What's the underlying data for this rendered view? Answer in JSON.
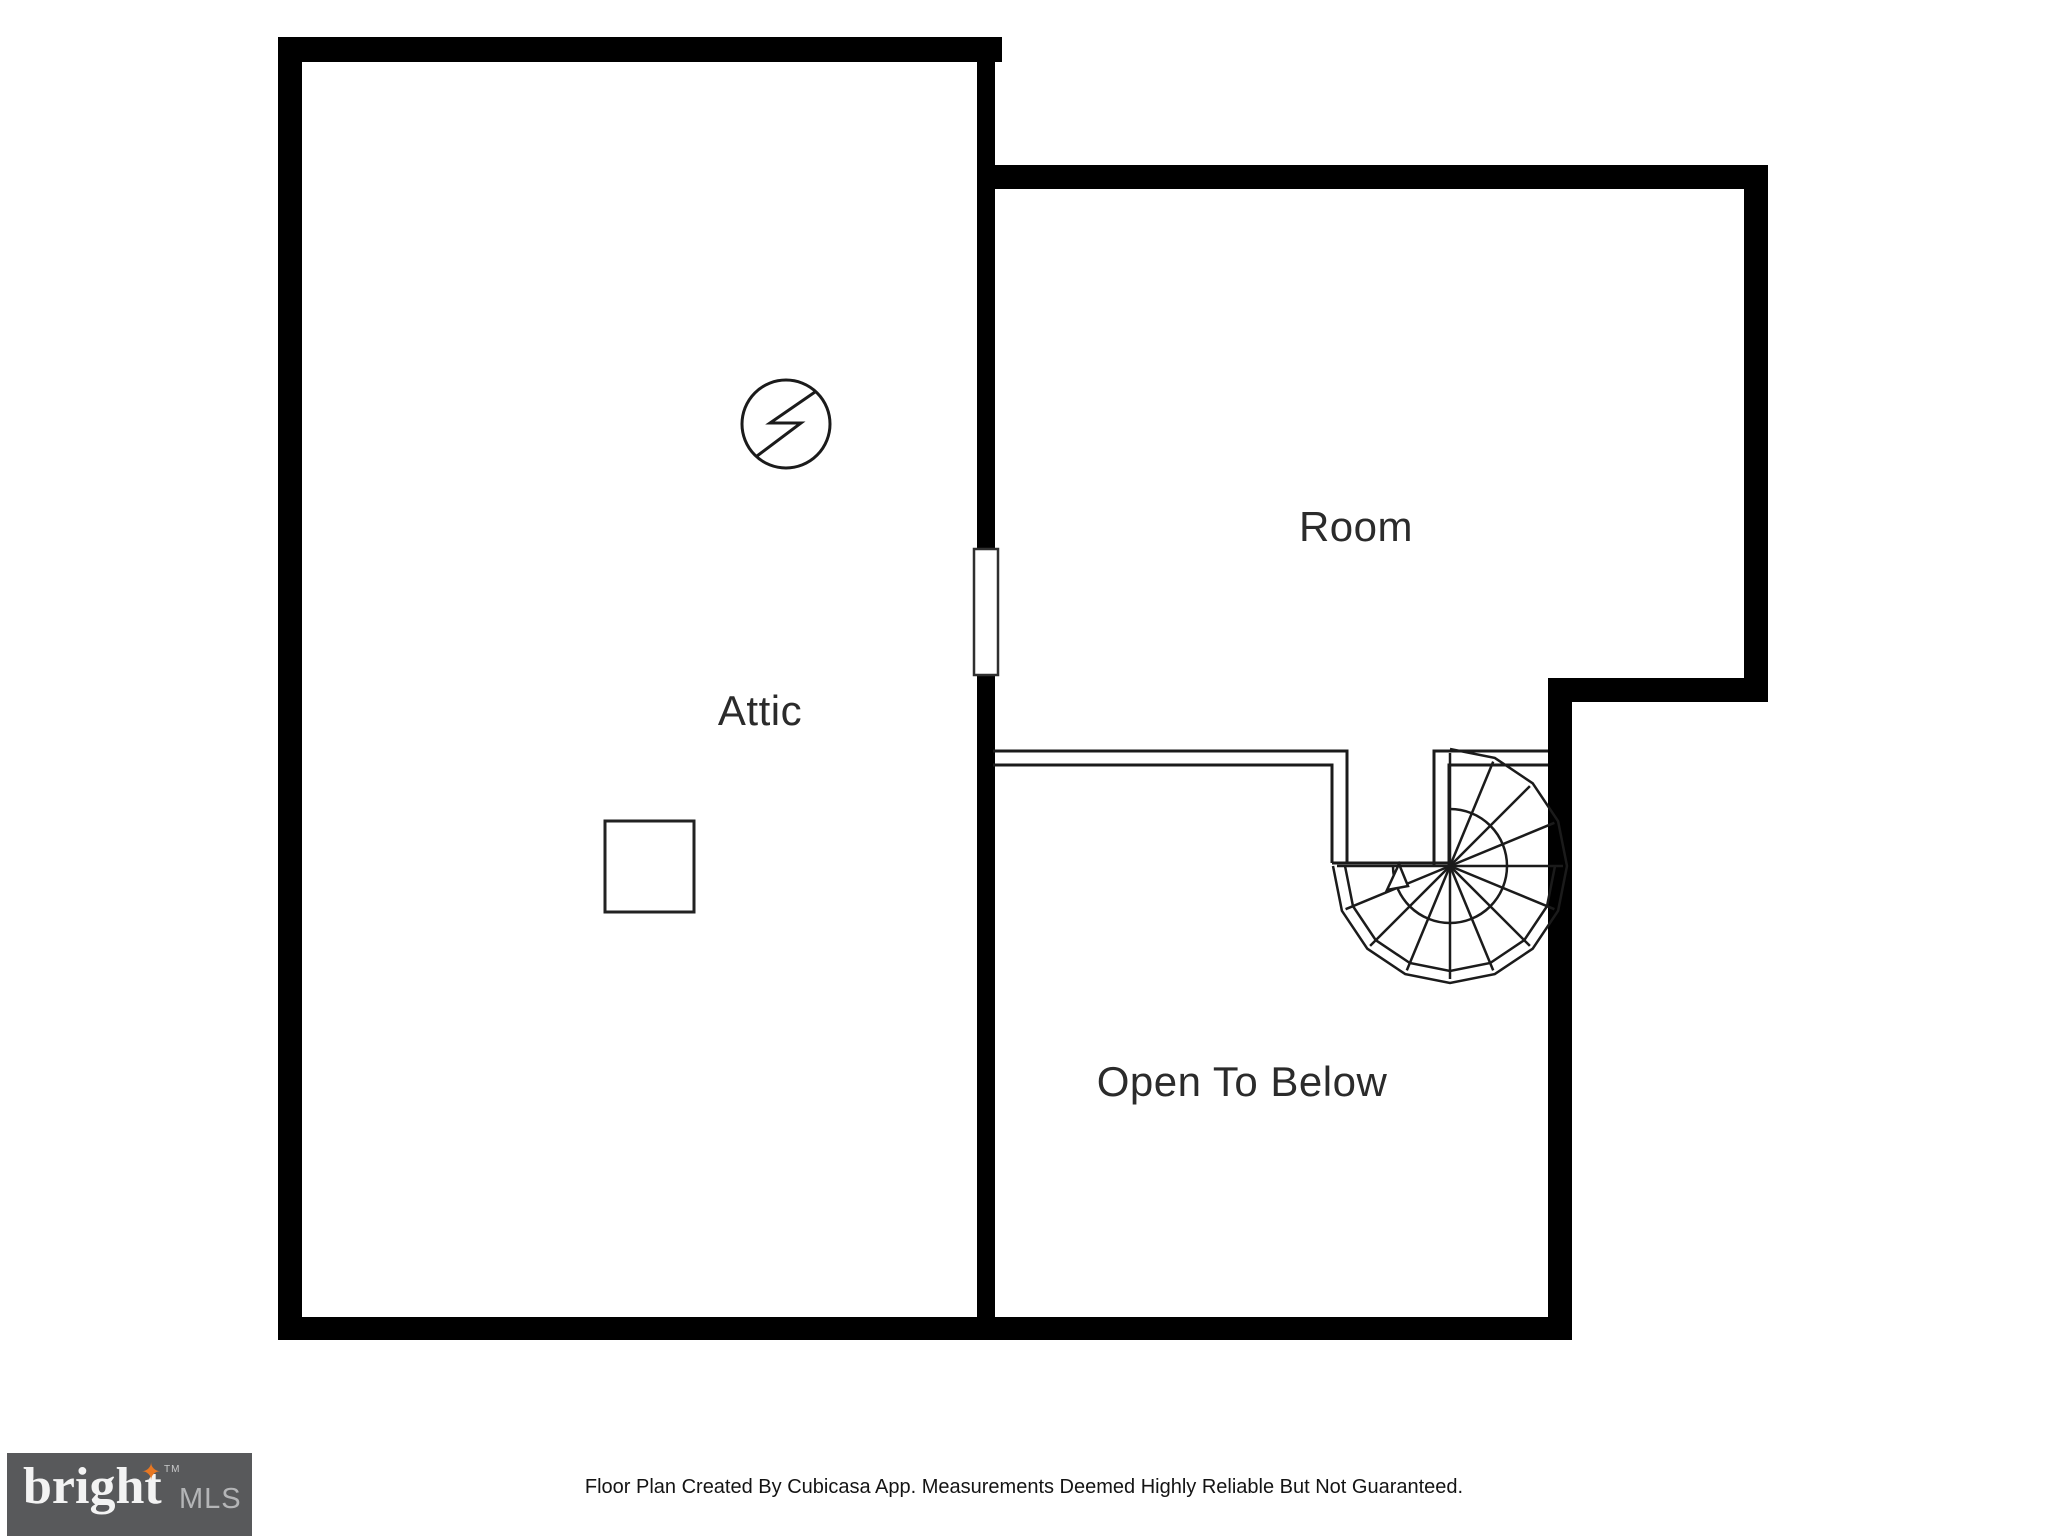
{
  "floorplan": {
    "labels": {
      "attic": "Attic",
      "room": "Room",
      "open_to_below": "Open To Below"
    }
  },
  "footer": {
    "disclaimer": "Floor Plan Created By Cubicasa App. Measurements Deemed Highly Reliable But Not Guaranteed."
  },
  "logo": {
    "brand": "bright",
    "tm": "TM",
    "suffix": "MLS",
    "star": "✦"
  },
  "icons": {
    "electrical_symbol": "circle-with-lightning-bolt",
    "spiral_staircase": "radial-tread-fan",
    "stair_direction_arrow": "small-triangle-arrow",
    "door_opening": "white-gap-in-wall",
    "access_square": "outlined-square",
    "logo_sparkle": "✦"
  },
  "colors": {
    "background": "#ffffff",
    "wall": "#000000",
    "thin_line": "#1b1b1b",
    "label_text": "#2b2b2b",
    "footer_text": "#141414",
    "logo_background": "#58595b",
    "logo_brand_text": "#f3f3f3",
    "logo_mls_text": "#b4b5b7",
    "logo_star": "#e87722"
  }
}
